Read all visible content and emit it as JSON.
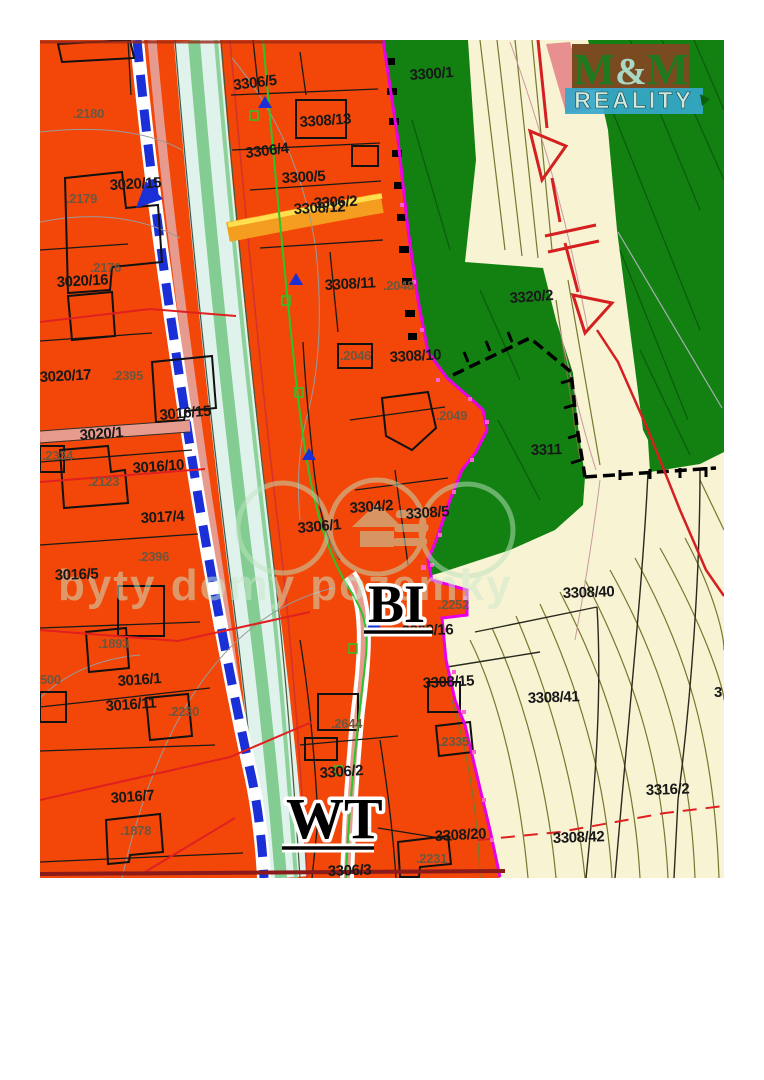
{
  "logo": {
    "m1": "M",
    "amp": "&",
    "m2": "M",
    "reality": "REALITY",
    "colors": {
      "box": "#7A4A20",
      "bar": "#35A8CC",
      "letters": "#1F7A1F",
      "amp": "#A9D9C5",
      "reality_text": "#CFEADC",
      "pink_band": "#E89090"
    }
  },
  "watermark": {
    "text": "byty domy pozemky",
    "color": "#CDE8CC"
  },
  "map": {
    "colors": {
      "residential_orange": "#F24708",
      "field_cream": "#F7F3D3",
      "forest_green": "#128112",
      "stream_cyan": "#E0F2EC",
      "stream_green_stripe": "#84CD92",
      "salmon_band": "#E79A8E",
      "utility_blue": "#1B2FD6",
      "boundary_magenta": "#E800E8",
      "power_line_red": "#D42020",
      "road_orange": "#F49D1E",
      "road_yellow_core": "#FFDF4E"
    },
    "zone_labels": [
      {
        "t": "BI",
        "x": 368,
        "y": 622,
        "s": 54
      },
      {
        "t": "WT",
        "x": 286,
        "y": 838,
        "s": 58
      }
    ],
    "parcel_labels": [
      {
        "t": "3306/5",
        "x": 234,
        "y": 90,
        "r": -7
      },
      {
        "t": "3308/13",
        "x": 300,
        "y": 127,
        "r": -4
      },
      {
        "t": "3306/4",
        "x": 246,
        "y": 158,
        "r": -7
      },
      {
        "t": "3300/5",
        "x": 282,
        "y": 183,
        "r": -3
      },
      {
        "t": "3306/2",
        "x": 314,
        "y": 208,
        "r": -3
      },
      {
        "t": "3308/12",
        "x": 294,
        "y": 214,
        "r": -3,
        "c": "#8B8B2E"
      },
      {
        "t": "3300/1",
        "x": 410,
        "y": 80,
        "r": -4
      },
      {
        "t": "3308/11",
        "x": 325,
        "y": 290,
        "r": -3
      },
      {
        "t": "3308/10",
        "x": 390,
        "y": 362,
        "r": -3
      },
      {
        "t": "3320/2",
        "x": 510,
        "y": 303,
        "r": -4
      },
      {
        "t": "3311",
        "x": 531,
        "y": 455,
        "r": -2
      },
      {
        "t": "3304/2",
        "x": 350,
        "y": 513,
        "r": -4
      },
      {
        "t": "3308/5",
        "x": 406,
        "y": 519,
        "r": -4
      },
      {
        "t": "3306/1",
        "x": 298,
        "y": 533,
        "r": -5
      },
      {
        "t": "3020/15",
        "x": 110,
        "y": 190,
        "r": -3
      },
      {
        "t": "3020/16",
        "x": 57,
        "y": 287,
        "r": -3
      },
      {
        "t": "3020/17",
        "x": 40,
        "y": 382,
        "r": -3
      },
      {
        "t": "3020/1",
        "x": 80,
        "y": 440,
        "r": -4
      },
      {
        "t": "3016/15",
        "x": 160,
        "y": 420,
        "r": -5
      },
      {
        "t": "3016/10",
        "x": 133,
        "y": 473,
        "r": -4
      },
      {
        "t": "3017/4",
        "x": 141,
        "y": 523,
        "r": -3
      },
      {
        "t": "3016/5",
        "x": 55,
        "y": 580,
        "r": -2
      },
      {
        "t": "3016/1",
        "x": 118,
        "y": 686,
        "r": -4
      },
      {
        "t": "3016/11",
        "x": 106,
        "y": 711,
        "r": -4
      },
      {
        "t": "3016/7",
        "x": 111,
        "y": 803,
        "r": -4
      },
      {
        "t": "3308/40",
        "x": 563,
        "y": 598,
        "r": -2
      },
      {
        "t": "3308/16",
        "x": 402,
        "y": 636,
        "r": -2
      },
      {
        "t": "3308/15",
        "x": 423,
        "y": 688,
        "r": -3
      },
      {
        "t": "3308/41",
        "x": 528,
        "y": 703,
        "r": -2
      },
      {
        "t": "3308/20",
        "x": 435,
        "y": 841,
        "r": -3
      },
      {
        "t": "3308/42",
        "x": 553,
        "y": 843,
        "r": -2
      },
      {
        "t": "3316/2",
        "x": 646,
        "y": 795,
        "r": -2
      },
      {
        "t": "3306/2",
        "x": 320,
        "y": 778,
        "r": -4
      },
      {
        "t": "3306/3",
        "x": 328,
        "y": 876,
        "r": -2
      },
      {
        "t": "3",
        "x": 714,
        "y": 697,
        "r": 0
      }
    ],
    "building_labels": [
      {
        "t": ".2180",
        "x": 73,
        "y": 118
      },
      {
        "t": ".2179",
        "x": 66,
        "y": 203
      },
      {
        "t": ".2176",
        "x": 90,
        "y": 272
      },
      {
        "t": ".2395",
        "x": 112,
        "y": 380
      },
      {
        "t": ".2334",
        "x": 42,
        "y": 460
      },
      {
        "t": ".2123",
        "x": 88,
        "y": 486
      },
      {
        "t": ".2396",
        "x": 138,
        "y": 561
      },
      {
        "t": ".1893",
        "x": 98,
        "y": 648
      },
      {
        "t": ".2230",
        "x": 168,
        "y": 716
      },
      {
        "t": ".1878",
        "x": 120,
        "y": 835
      },
      {
        "t": "500",
        "x": 40,
        "y": 684
      },
      {
        "t": ".2046",
        "x": 340,
        "y": 360
      },
      {
        "t": ".2048",
        "x": 383,
        "y": 290
      },
      {
        "t": ".2049",
        "x": 436,
        "y": 420
      },
      {
        "t": ".2252",
        "x": 438,
        "y": 609
      },
      {
        "t": ".2644",
        "x": 331,
        "y": 728
      },
      {
        "t": ".2335",
        "x": 438,
        "y": 746
      },
      {
        "t": ".2231",
        "x": 416,
        "y": 863
      }
    ]
  }
}
